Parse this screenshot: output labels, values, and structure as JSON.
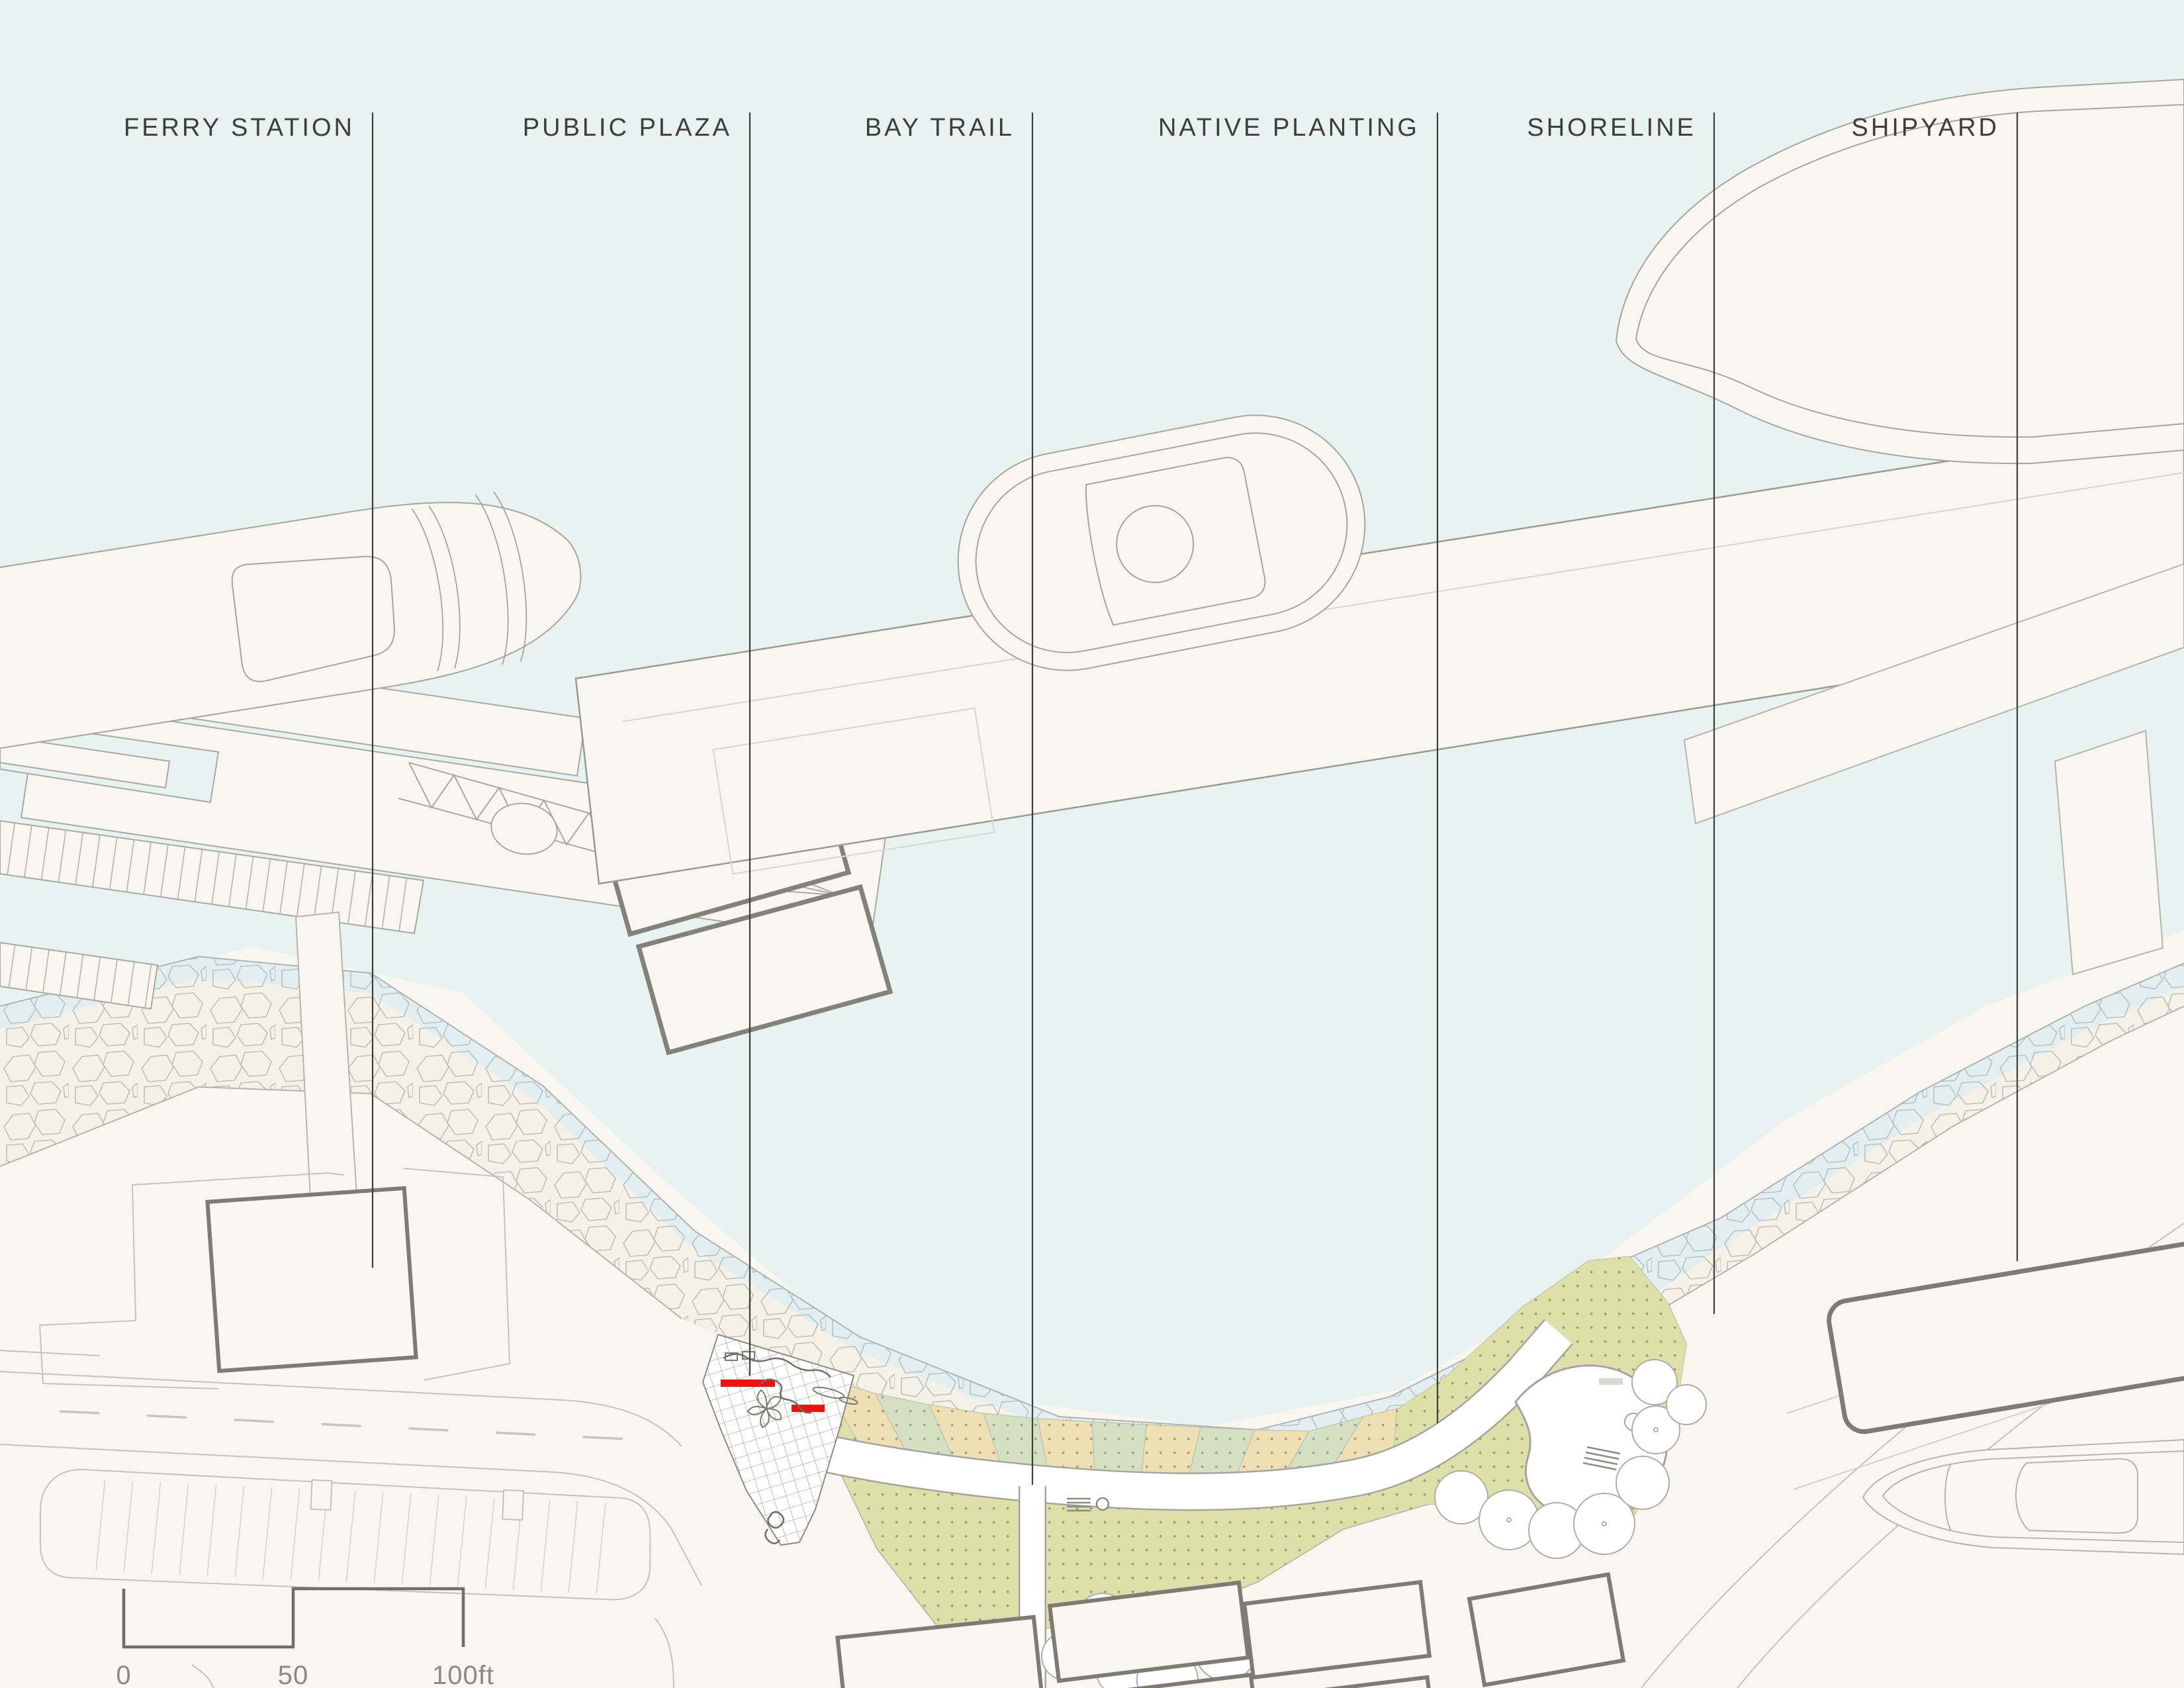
{
  "drawing": {
    "type": "waterfront-site-plan",
    "callouts": [
      {
        "label": "FERRY STATION"
      },
      {
        "label": "PUBLIC PLAZA"
      },
      {
        "label": "BAY TRAIL"
      },
      {
        "label": "NATIVE PLANTING"
      },
      {
        "label": "SHORELINE"
      },
      {
        "label": "SHIPYARD"
      }
    ],
    "scale_bar": {
      "zero": "0",
      "fifty": "50",
      "hundred": "100ft"
    },
    "colors": {
      "water": "#e7f2f1",
      "land": "#f8f6ef",
      "beach_sand": "#f5f1e6",
      "shallow_water_band": "#e3eef0",
      "stone_outline": "#b8c1c1",
      "planting_tan": "#eee0b3",
      "planting_sage": "#d5e0c3",
      "lawn": "#dfe0a9",
      "dot_olive": "#9c9f70",
      "path_white": "#ffffff",
      "edge_gray": "#a5a59f",
      "dark_outline": "#7c7c75",
      "leader_line": "#3d3d3a",
      "accent_red": "#f2100d"
    },
    "map_features": [
      "ferry-boat",
      "ferry-slip-decks",
      "trestle-pier",
      "gangway-truss",
      "floating-docks",
      "ferry-terminal-building",
      "parking-lot",
      "street",
      "public-plaza-paving-grid",
      "red-site-benches",
      "bay-trail-path",
      "overlook",
      "trees",
      "native-planting-stripes",
      "lawn",
      "riprap-shoreline",
      "main-pier",
      "tugboat",
      "cargo-ship",
      "finger-pier",
      "shipyard-building",
      "boat-under-construction",
      "scale-bar"
    ]
  }
}
